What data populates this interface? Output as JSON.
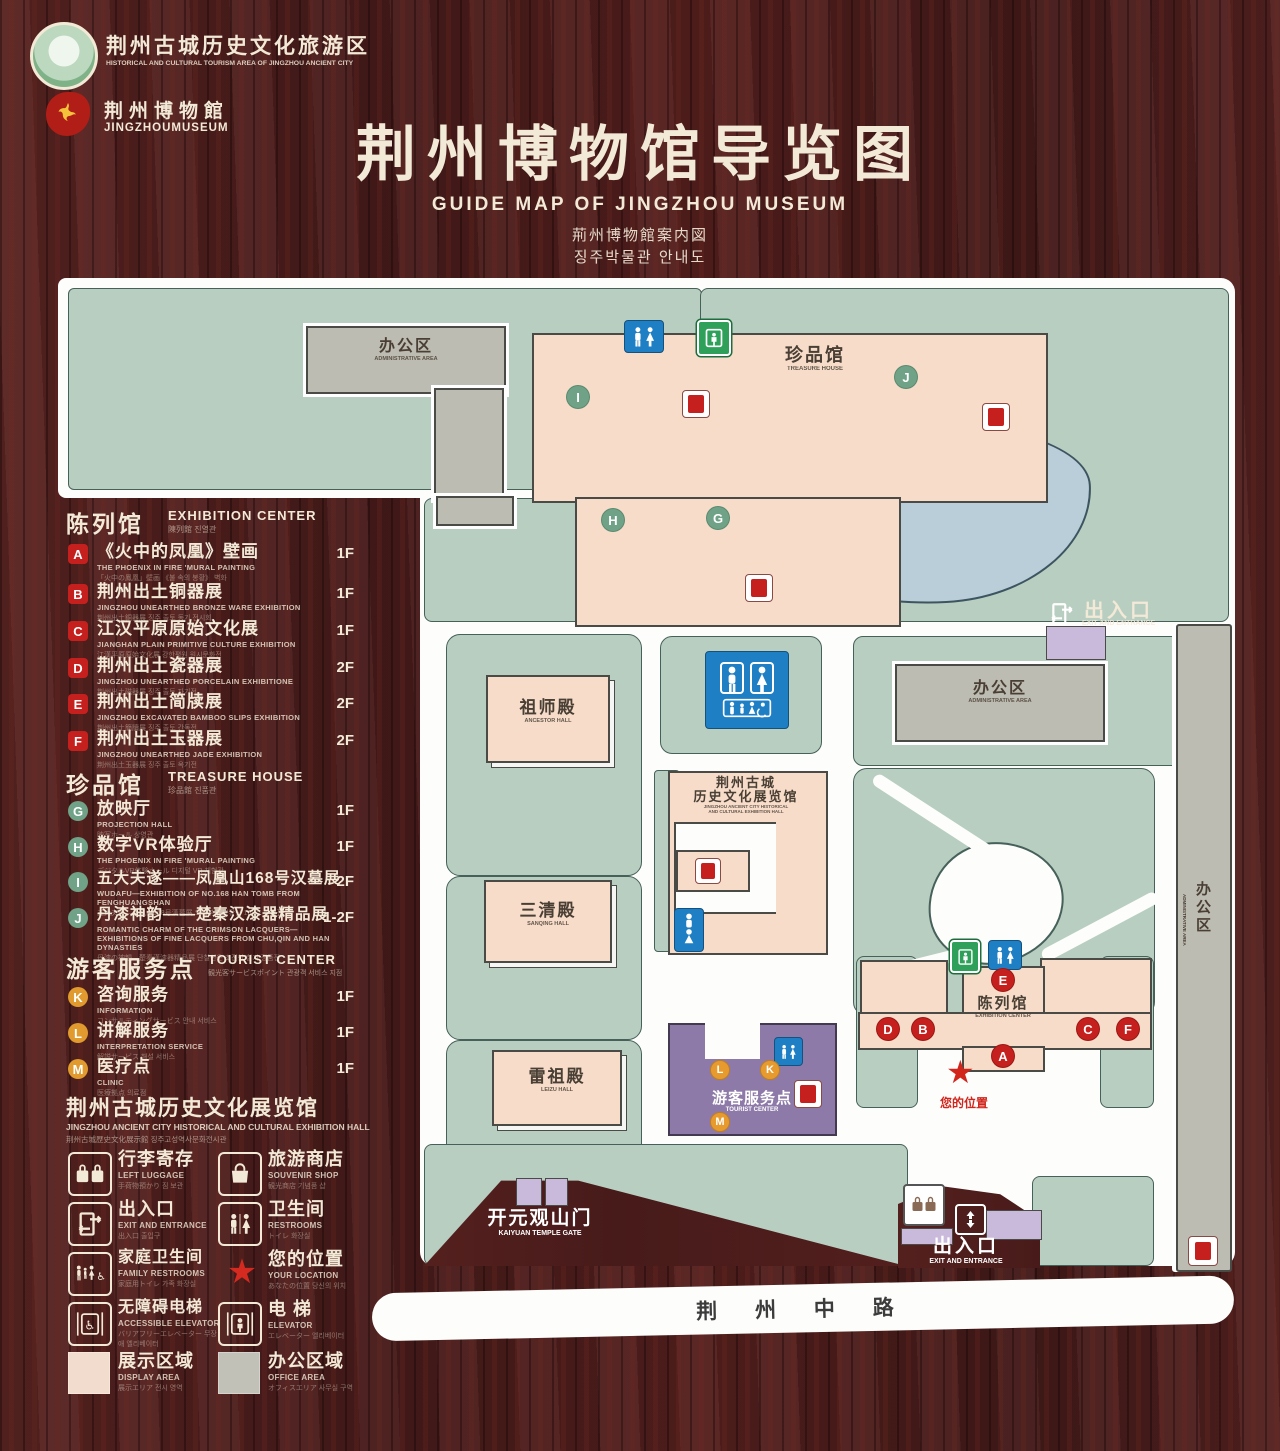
{
  "colors": {
    "wood": "#4c1d1b",
    "map_bg": "#fdfdfb",
    "lawn": "#b8cec1",
    "building_pink": "#f6dcc9",
    "building_gray": "#bdbcb2",
    "pond_blue": "#b9ced9",
    "service_purple": "#8d7aa8",
    "entrance_lavender": "#c9badb",
    "marker_red": "#c5201d",
    "marker_green": "#6fa287",
    "marker_orange": "#e79b2f",
    "restroom_blue": "#1f7fc4",
    "exit_green": "#2fa05a",
    "text_cream": "#f3e9d7"
  },
  "header": {
    "logo_tourism": {
      "cn": "荆州古城历史文化旅游区",
      "en": "HISTORICAL AND CULTURAL TOURISM AREA OF JINGZHOU ANCIENT CITY"
    },
    "logo_museum": {
      "cn": "荆州博物館",
      "en": "JINGZHOUMUSEUM"
    },
    "title": {
      "cn": "荆州博物馆导览图",
      "en": "GUIDE MAP OF JINGZHOU MUSEUM",
      "ja": "荊州博物館案内図",
      "ko": "징주박물관 안내도"
    }
  },
  "legend": {
    "sections": [
      {
        "title_cn": "陈列馆",
        "title_en": "EXHIBITION CENTER",
        "title_sub": "陳列館  진열관",
        "items": [
          {
            "letter": "A",
            "title": "《火中的凤凰》壁画",
            "en": "THE PHOENIX IN FIRE 'MURAL PAINTING",
            "sub": "「火中の鳳凰」壁画 《불 속의 봉황》 벽화",
            "floor": "1F"
          },
          {
            "letter": "B",
            "title": "荆州出土铜器展",
            "en": "JINGZHOU UNEARTHED BRONZE WARE EXHIBITION",
            "sub": "荆州出土銅器展  징주 출토 동기 전시회",
            "floor": "1F"
          },
          {
            "letter": "C",
            "title": "江汉平原原始文化展",
            "en": "JIANGHAN PLAIN PRIMITIVE CULTURE EXHIBITION",
            "sub": "江漢平原原始文化展  강한평원 원시문화전",
            "floor": "1F"
          },
          {
            "letter": "D",
            "title": "荆州出土瓷器展",
            "en": "JINGZHOU UNEARTHED PORCELAIN EXHIBITIONE",
            "sub": "荆州出土磁器展  징주 출토 자기전",
            "floor": "2F"
          },
          {
            "letter": "E",
            "title": "荆州出土简牍展",
            "en": "JINGZHOU EXCAVATED BAMBOO SLIPS EXHIBITION",
            "sub": "荆州出土簡牘展  징주 출토 간독전",
            "floor": "2F"
          },
          {
            "letter": "F",
            "title": "荆州出土玉器展",
            "en": "JINGZHOU UNEARTHED JADE EXHIBITION",
            "sub": "荆州出土玉器展  징주 출토 옥기전",
            "floor": "2F"
          }
        ]
      },
      {
        "title_cn": "珍品馆",
        "title_en": "TREASURE HOUSE",
        "title_sub": "珍品館  진품관",
        "items": [
          {
            "letter": "G",
            "title": "放映厅",
            "en": "PROJECTION HALL",
            "sub": "映写ホール  상영관",
            "floor": "1F"
          },
          {
            "letter": "H",
            "title": "数字VR体验厅",
            "en": "THE PHOENIX IN FIRE 'MURAL PAINTING",
            "sub": "デジタルVR体験ホール  디지털 VR 체험관",
            "floor": "1F"
          },
          {
            "letter": "I",
            "title": "五大夫遂——凤凰山168号汉墓展",
            "en": "WUDAFU—EXHIBITION OF NO.168 HAN TOMB FROM FENGHUANGSHAN",
            "sub": "五大夫遂—鳳凰山168号漢墓展  오대부수 봉황산 168호 한묘전",
            "floor": "2F"
          },
          {
            "letter": "J",
            "title": "丹漆神韵——楚秦汉漆器精品展",
            "en": "ROMANTIC CHARM OF THE CRIMSON LACQUERS— EXHIBITIONS OF FINE LACQUERS FROM CHU,QIN AND HAN DYNASTIES",
            "sub": "丹漆の神韻—楚秦漢漆器精品展  단칠신운 초진한 칠기 정품전",
            "floor": "1-2F"
          }
        ]
      },
      {
        "title_cn": "游客服务点",
        "title_en": "TOURIST CENTER",
        "title_sub": "観光客サービスポイント  관광객 서비스 지점",
        "items": [
          {
            "letter": "K",
            "title": "咨询服务",
            "en": "INFORMATION",
            "sub": "コンサルティングサービス  안내 서비스",
            "floor": "1F"
          },
          {
            "letter": "L",
            "title": "讲解服务",
            "en": "INTERPRETATION SERVICE",
            "sub": "解説サービス  해설 서비스",
            "floor": "1F"
          },
          {
            "letter": "M",
            "title": "医疗点",
            "en": "CLINIC",
            "sub": "医療拠点  의료점",
            "floor": "1F"
          }
        ]
      }
    ],
    "hall_note": {
      "cn": "荆州古城历史文化展览馆",
      "en": "JINGZHOU ANCIENT CITY HISTORICAL AND CULTURAL EXHIBITION HALL",
      "sub": "荆州古城歴史文化展示館    징주고성역사문화전시관"
    },
    "facilities": [
      {
        "cn": "行李寄存",
        "en": "LEFT LUGGAGE",
        "sub": "手荷物預かり  짐 보관",
        "icon": "luggage-icon"
      },
      {
        "cn": "旅游商店",
        "en": "SOUVENIR SHOP",
        "sub": "観光商店  기념품 샵",
        "icon": "shop-bag-icon"
      },
      {
        "cn": "出入口",
        "en": "EXIT AND ENTRANCE",
        "sub": "出入口  출입구",
        "icon": "exit-door-icon"
      },
      {
        "cn": "卫生间",
        "en": "RESTROOMS",
        "sub": "トイレ  화장실",
        "icon": "restroom-icon"
      },
      {
        "cn": "家庭卫生间",
        "en": "FAMILY RESTROOMS",
        "sub": "家庭用トイレ  가족 화장실",
        "icon": "family-restroom-icon"
      },
      {
        "cn": "您的位置",
        "en": "YOUR LOCATION",
        "sub": "あなたの位置  당신의 위치",
        "icon": "location-star-icon"
      },
      {
        "cn": "无障碍电梯",
        "en": "ACCESSIBLE ELEVATOR",
        "sub": "バリアフリーエレベーター  무장애 엘리베이터",
        "icon": "accessible-elevator-icon"
      },
      {
        "cn": "电  梯",
        "en": "ELEVATOR",
        "sub": "エレベーター  엘리베이터",
        "icon": "elevator-icon"
      }
    ],
    "areas": [
      {
        "cn": "展示区域",
        "en": "DISPLAY AREA",
        "sub": "展示エリア  전시 영역",
        "color": "#f2dccd"
      },
      {
        "cn": "办公区域",
        "en": "OFFICE AREA",
        "sub": "オフィスエリア  사무실 구역",
        "color": "#c2c1b8"
      }
    ]
  },
  "map": {
    "road": "荆 州 中 路",
    "labels": {
      "admin_left_cn": "办公区",
      "admin_left_en": "ADMINISTRATIVE AREA",
      "treasure_cn": "珍品馆",
      "treasure_en": "TREASURE HOUSE",
      "ancestor_cn": "祖师殿",
      "ancestor_en": "ANCESTOR HALL",
      "sanqing_cn": "三清殿",
      "sanqing_en": "SANQING HALL",
      "leizu_cn": "雷祖殿",
      "leizu_en": "LEIZU HALL",
      "hall_cn1": "荆州古城",
      "hall_cn2": "历史文化展览馆",
      "hall_en1": "JINGZHOU ANCIENT CITY HISTORICAL",
      "hall_en2": "AND CULTURAL EXHIBITION HALL",
      "admin_right_cn": "办公区",
      "admin_right_en": "ADMINISTRATIVE AREA",
      "strip_cn": "办公区",
      "strip_en": "ADMINISTRATIVE AREA",
      "exhibition_cn": "陈列馆",
      "exhibition_en": "EXHIBITION CENTER",
      "tourist_cn": "游客服务点",
      "tourist_en": "TOURIST CENTER",
      "gate_cn": "开元观山门",
      "gate_en": "KAIYUAN TEMPLE GATE",
      "exit_cn": "出入口",
      "exit_en": "EXIT AND ENTRANCE",
      "location_cn": "您的位置"
    },
    "markers": {
      "green": [
        "I",
        "J",
        "H",
        "G"
      ],
      "red": [
        "E",
        "D",
        "B",
        "A",
        "C",
        "F"
      ],
      "orange": [
        "L",
        "K",
        "M"
      ]
    }
  }
}
